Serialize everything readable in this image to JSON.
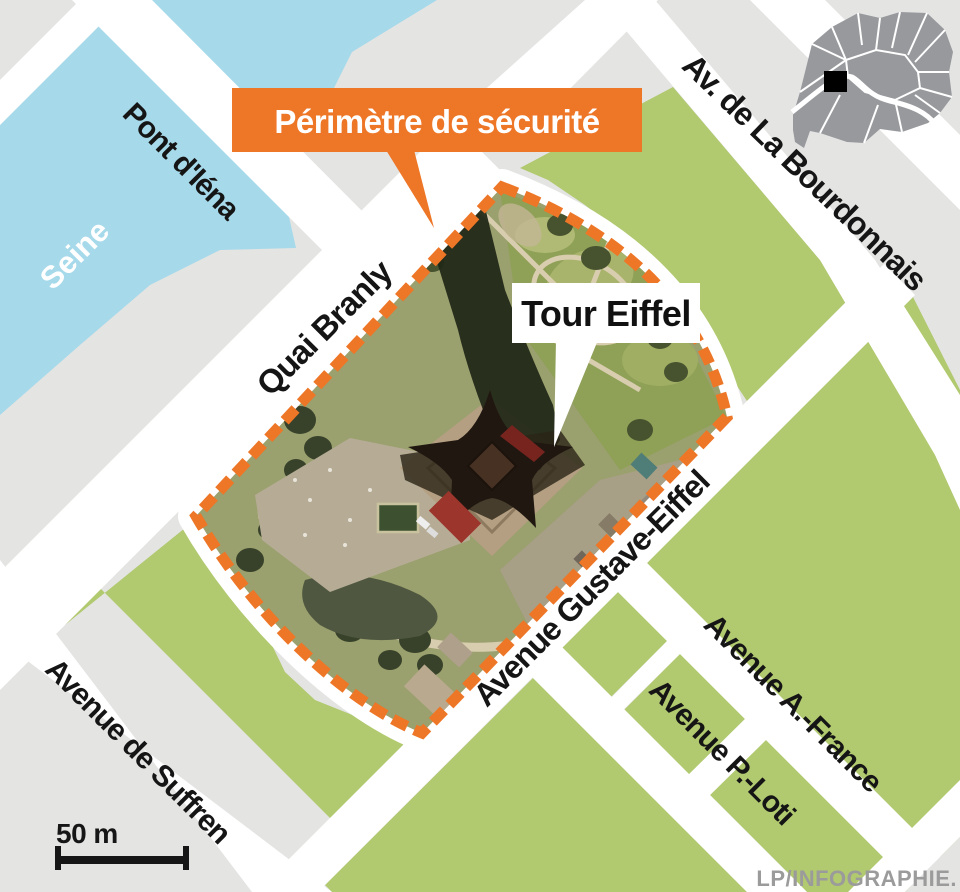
{
  "map": {
    "callout": {
      "label": "Périmètre de sécurité"
    },
    "tower": {
      "label": "Tour Eiffel"
    },
    "labels": {
      "seine": "Seine",
      "pont_iena": "Pont d'Iéna",
      "quai_branly": "Quai Branly",
      "bourdonnais": "Av. de La Bourdonnais",
      "gustave_eiffel": "Avenue Gustave-Eiffel",
      "avenue_a_france": "Avenue A.-France",
      "avenue_p_loti": "Avenue P.-Loti",
      "suffren": "Avenue de Suffren"
    },
    "scale": {
      "label": "50 m"
    },
    "credit": "LP/INFOGRAPHIE."
  },
  "colors": {
    "orange": "#ee7627",
    "green": "#b1c96f",
    "water": "#a6d9ea",
    "land_gray": "#e4e4e3",
    "street_white": "#ffffff",
    "inset_gray": "#97999d",
    "credit_gray": "#9b9b9b"
  }
}
